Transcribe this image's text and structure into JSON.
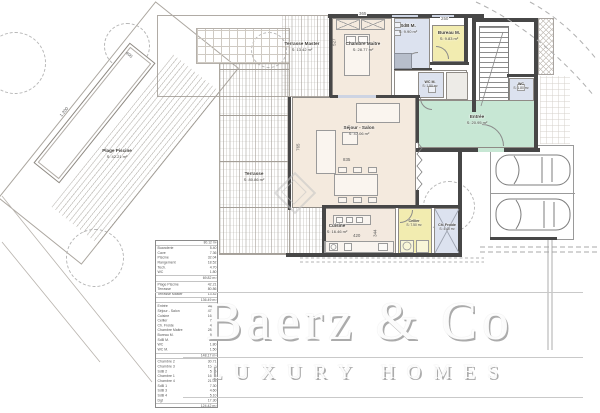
{
  "watermark": {
    "brand": "Baerz & Co",
    "tagline": "LUXURY HOMES"
  },
  "rooms": {
    "terrasse_master": {
      "name": "Terrasse Master",
      "area": "S: 13.42 m²"
    },
    "chambre_maitre": {
      "name": "Chambre Maitre",
      "area": "S: 28.77 m²"
    },
    "sdb_m": {
      "name": "SdB M.",
      "area": "S: 9.90 m²"
    },
    "bureau_m": {
      "name": "Bureau M.",
      "area": "S: 9.83 m²"
    },
    "wc_m": {
      "name": "WC M.",
      "area": "S: 1.50 m²"
    },
    "wc": {
      "name": "WC",
      "area": "S: 1.80 m²"
    },
    "entree": {
      "name": "Entrée",
      "area": "S: 20.95 m²"
    },
    "sejour": {
      "name": "Séjour - Salon",
      "area": "S: 47.06 m²"
    },
    "terrasse": {
      "name": "Terrasse",
      "area": "S: 80.86 m²"
    },
    "plage_piscine": {
      "name": "Plage Piscine",
      "area": "S: 42.21 m²"
    },
    "cuisine": {
      "name": "Cuisine",
      "area": "S: 16.46 m²"
    },
    "cellier": {
      "name": "Cellier",
      "area": "S: 7.50 m²"
    },
    "ch_froide": {
      "name": "Ch. Froide",
      "area": "S: 4.40 m²"
    }
  },
  "dimensions": {
    "top_left": "365",
    "top_right": "250",
    "chambre_h": "527",
    "sejour_w": "835",
    "sejour_h": "765",
    "cuisine_w": "420",
    "cuisine_h": "344",
    "pool_l": "1.200",
    "pool_w": "400"
  },
  "schedule": {
    "header": {
      "label": "Surfaces",
      "value": "80.12 m²"
    },
    "sections": [
      {
        "rows": [
          [
            "Buanderie",
            "5.40"
          ],
          [
            "Cave",
            "7.36"
          ],
          [
            "Piscine",
            "32.04"
          ],
          [
            "Rangement",
            "18.52"
          ],
          [
            "Tech.",
            "4.70"
          ],
          [
            "WC",
            "1.80"
          ]
        ],
        "total": "69.82 m²"
      },
      {
        "rows": [
          [
            "Plage Piscine",
            "42.21"
          ],
          [
            "Terrasse",
            "80.86"
          ],
          [
            "Terrasse Master",
            "13.42"
          ]
        ],
        "total": "136.49 m²"
      },
      {
        "rows": [
          [
            "Entrée",
            "20.95"
          ],
          [
            "Séjour - Salon",
            "47.06"
          ],
          [
            "Cuisine",
            "16.46"
          ],
          [
            "Cellier",
            "7.50"
          ],
          [
            "Ch. Froide",
            "4.40"
          ],
          [
            "Chambre Maitre",
            "28.77"
          ],
          [
            "Bureau M.",
            "9.83"
          ],
          [
            "SdB M.",
            "9.90"
          ],
          [
            "WC",
            "1.80"
          ],
          [
            "WC M.",
            "1.50"
          ]
        ],
        "total": "148.17 m²"
      },
      {
        "rows": [
          [
            "Chambre 2",
            "30.71"
          ],
          [
            "Chambre 3",
            "15.75"
          ],
          [
            "SdB 2",
            "5.75"
          ],
          [
            "Chambre 1",
            "16.86"
          ],
          [
            "Chambre 4",
            "21.05"
          ],
          [
            "SdB 1",
            "7.30"
          ],
          [
            "SdB 3",
            "4.60"
          ],
          [
            "SdB 4",
            "5.10"
          ],
          [
            "Dgt",
            "17.30"
          ]
        ],
        "total": "124.42 m²"
      }
    ],
    "grand_total": "272.59 m²"
  },
  "colors": {
    "room_beige": "#f4eade",
    "room_blue": "#dce2ef",
    "room_yellow": "#f2ecb0",
    "room_green": "#c7e7d4",
    "wall_dark": "#474747"
  }
}
